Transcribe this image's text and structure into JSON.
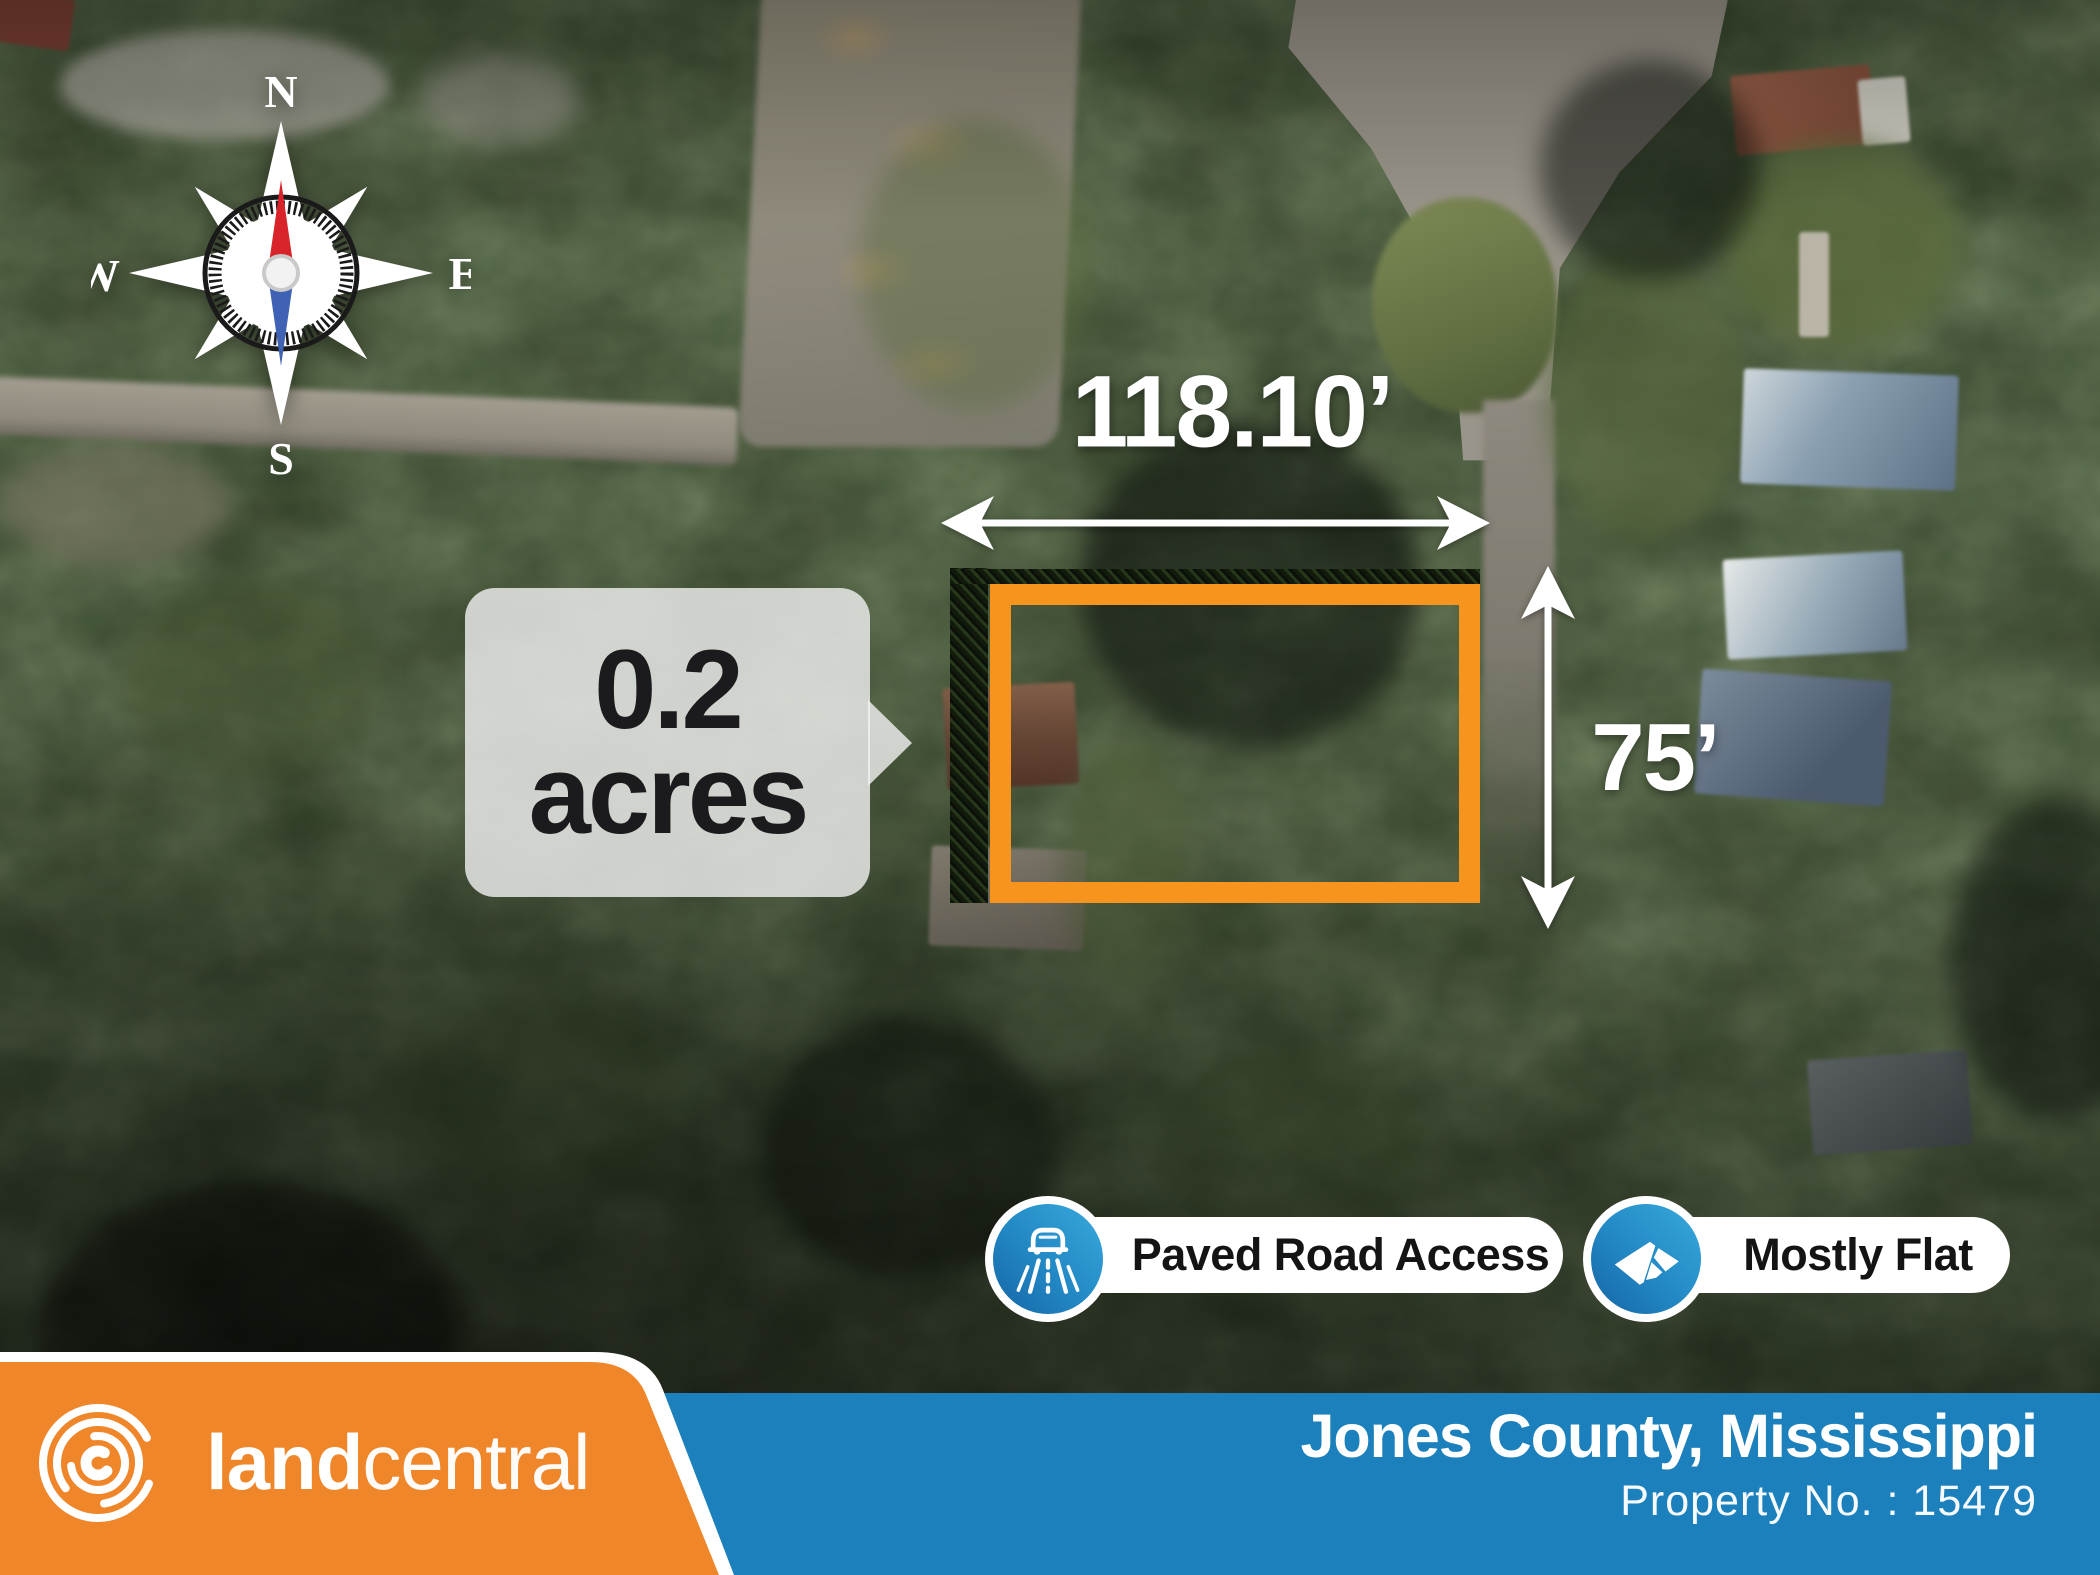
{
  "colors": {
    "brand_orange": "#F0862A",
    "brand_blue": "#1B80BB",
    "lot_outline_orange": "#F7941E",
    "badge_icon_blue_light": "#38A9DC",
    "badge_icon_blue_dark": "#1565A5",
    "callout_text_dark": "#1B1B1D",
    "overlay_white": "#FFFFFF"
  },
  "compass": {
    "north": "N",
    "east": "E",
    "south": "S",
    "west": "W"
  },
  "dimensions": {
    "width_label": "118.10’",
    "height_label": "75’"
  },
  "area_callout": {
    "line1": "0.2",
    "line2": "acres"
  },
  "badges": [
    {
      "icon": "paved-road-icon",
      "label": "Paved Road Access"
    },
    {
      "icon": "flat-terrain-icon",
      "label": "Mostly Flat"
    }
  ],
  "footer": {
    "brand": {
      "word_bold": "land",
      "word_light": "central"
    },
    "location": "Jones County, Mississippi",
    "property_number": "Property No. : 15479"
  }
}
